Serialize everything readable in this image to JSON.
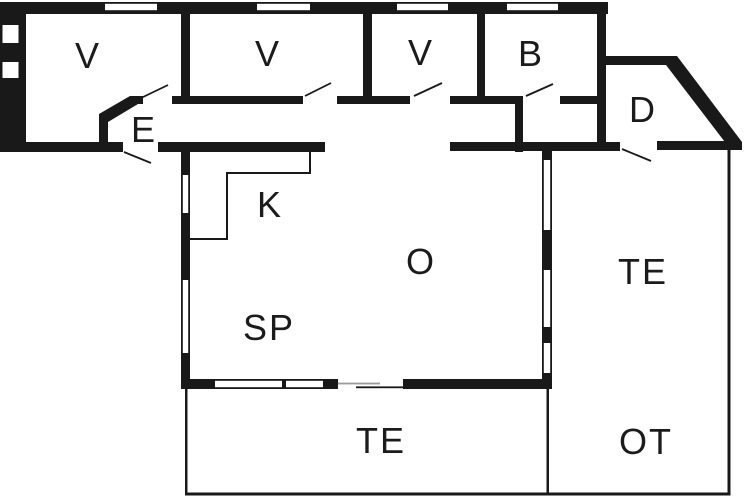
{
  "figure": {
    "kind": "floor-plan",
    "background_color": "#ffffff",
    "wall_color": "#191919",
    "sliding_door_line_color": "#9b9b9b"
  },
  "rooms": [
    {
      "id": "room-v1",
      "label": "V"
    },
    {
      "id": "room-v2",
      "label": "V"
    },
    {
      "id": "room-v3",
      "label": "V"
    },
    {
      "id": "room-b",
      "label": "B"
    },
    {
      "id": "room-d",
      "label": "D"
    },
    {
      "id": "room-e",
      "label": "E"
    },
    {
      "id": "room-k",
      "label": "K"
    },
    {
      "id": "room-o",
      "label": "O"
    },
    {
      "id": "room-sp",
      "label": "SP"
    },
    {
      "id": "terrace-right",
      "label": "TE"
    },
    {
      "id": "terrace-bottom",
      "label": "TE"
    },
    {
      "id": "terrace-ot",
      "label": "OT"
    }
  ]
}
